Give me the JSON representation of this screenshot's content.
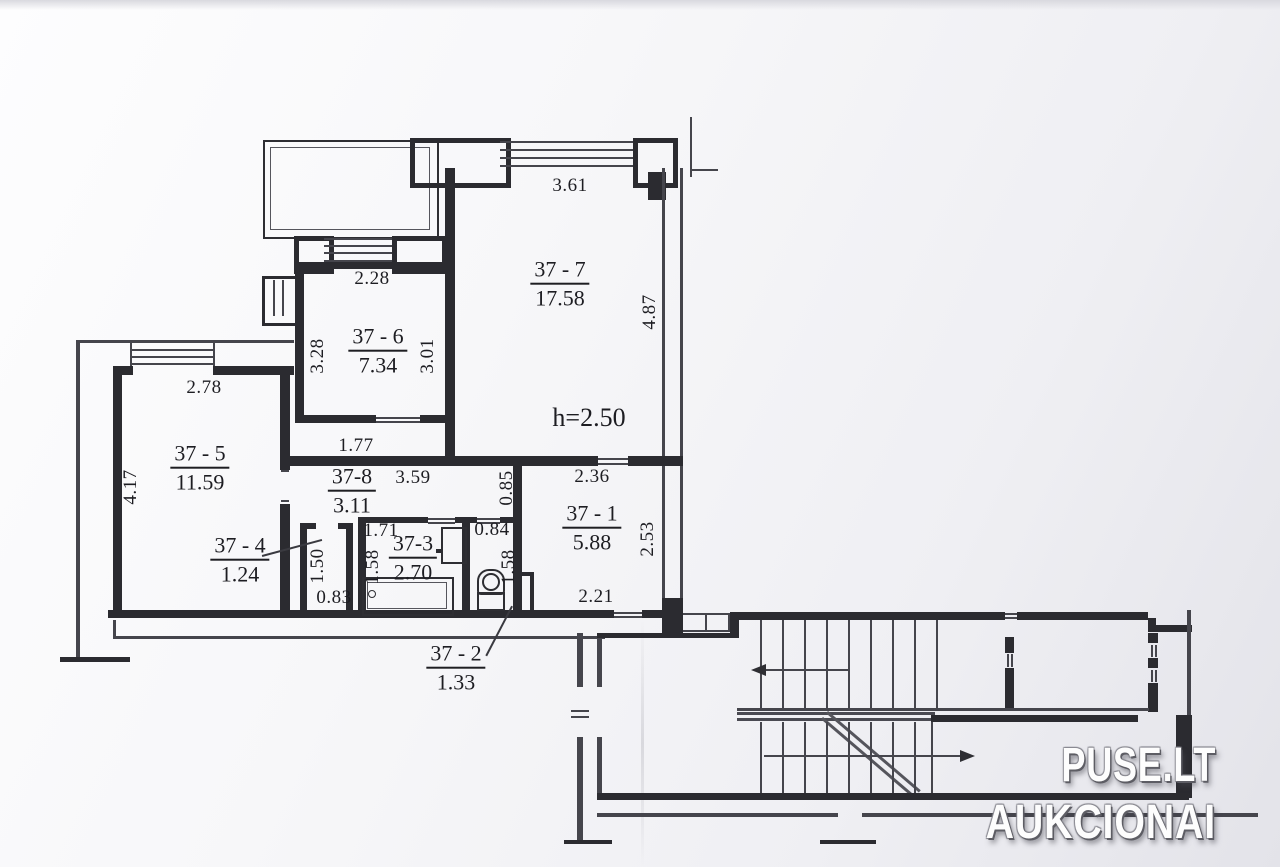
{
  "watermark": {
    "line1": "PUSE.LT",
    "line2": "AUKCIONAI"
  },
  "plan": {
    "height_note": "h=2.50",
    "rooms": [
      {
        "id": "37 - 7",
        "area": "17.58"
      },
      {
        "id": "37 - 6",
        "area": "7.34"
      },
      {
        "id": "37 - 5",
        "area": "11.59"
      },
      {
        "id": "37 - 4",
        "area": "1.24"
      },
      {
        "id": "37-8",
        "area": "3.11"
      },
      {
        "id": "37-3",
        "area": "2.70"
      },
      {
        "id": "37 - 1",
        "area": "5.88"
      },
      {
        "id": "37 - 2",
        "area": "1.33"
      }
    ],
    "dims": [
      "3.61",
      "2.28",
      "3.28",
      "3.01",
      "4.87",
      "2.78",
      "4.17",
      "1.77",
      "3.59",
      "0.85",
      "2.36",
      "2.53",
      "1.50",
      "0.83",
      "1.71",
      "1.58",
      "0.84",
      "1.58",
      "2.21"
    ]
  }
}
